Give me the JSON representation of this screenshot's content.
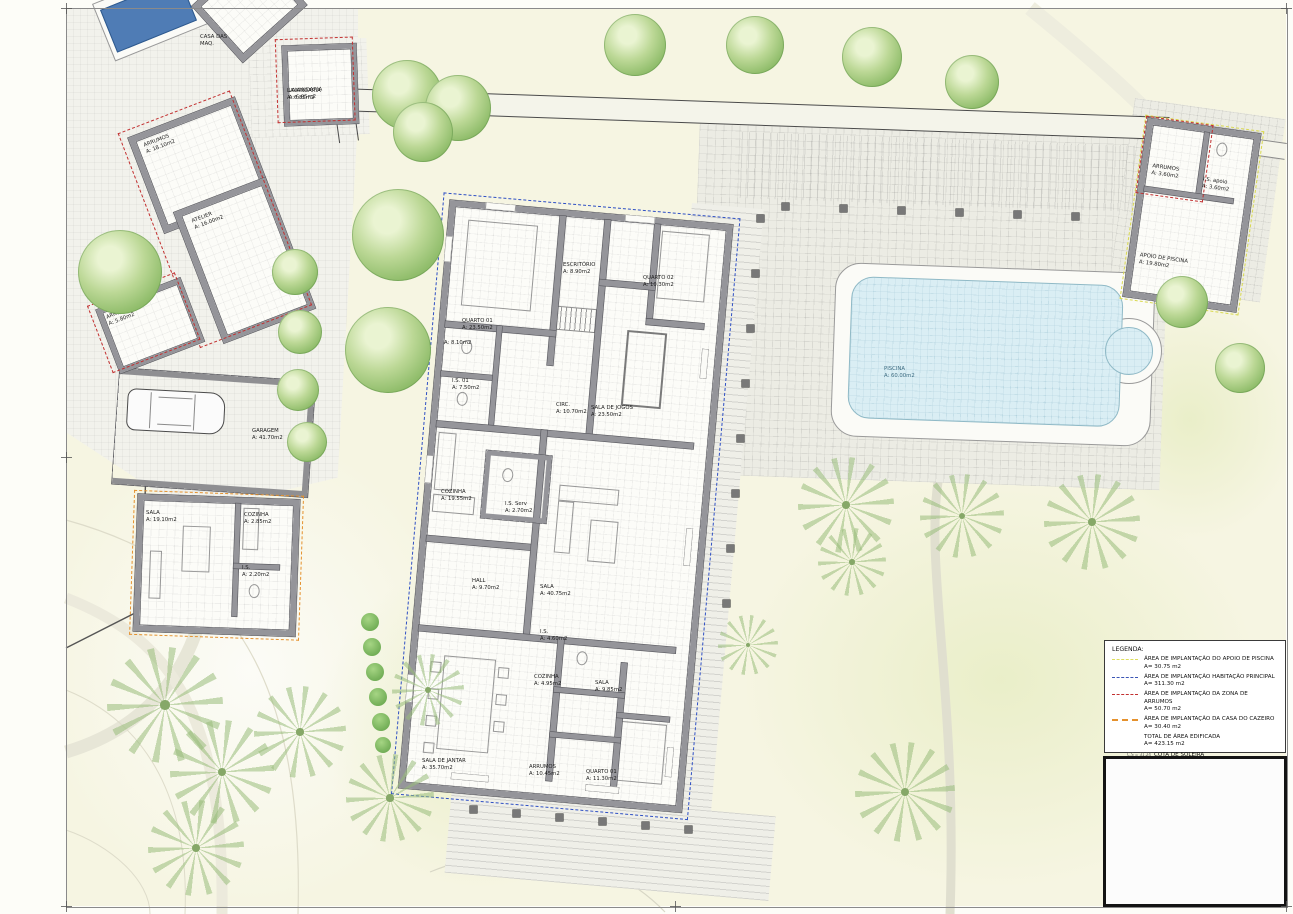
{
  "rooms": {
    "q1": {
      "n": "QUARTO 01",
      "a": "A: 23.50m2"
    },
    "is02": {
      "n": "I.S. 02",
      "a": "A: 8.10m2"
    },
    "escr": {
      "n": "ESCRITÓRIO",
      "a": "A: 8.90m2"
    },
    "q2": {
      "n": "QUARTO 02",
      "a": "A: 10.30m2"
    },
    "is01": {
      "n": "I.S. 01",
      "a": "A: 7.50m2"
    },
    "circ": {
      "n": "CIRC.",
      "a": "A: 10.70m2"
    },
    "jogos": {
      "n": "SALA DE JOGOS",
      "a": "A: 23.50m2"
    },
    "coz": {
      "n": "COZINHA",
      "a": "A: 19.55m2"
    },
    "isserv": {
      "n": "I.S. Serv",
      "a": "A: 2.70m2"
    },
    "hall": {
      "n": "HALL",
      "a": "A: 9.70m2"
    },
    "sala": {
      "n": "SALA",
      "a": "A: 40.75m2"
    },
    "jantar": {
      "n": "SALA DE JANTAR",
      "a": "A: 35.70m2"
    },
    "isb": {
      "n": "I.S.",
      "a": "A: 4.60m2"
    },
    "cozb": {
      "n": "COZINHA",
      "a": "A: 4.95m2"
    },
    "salab": {
      "n": "SALA",
      "a": "A: 9.85m2"
    },
    "arrb": {
      "n": "ARRUMOS",
      "a": "A: 10.45m2"
    },
    "q1b": {
      "n": "QUARTO 01",
      "a": "A: 11.30m2"
    }
  },
  "annex": {
    "casamaq": {
      "n": "CASA DAS",
      "a": "MAQ."
    },
    "lav": {
      "n": "LAVANDARIA",
      "a": "A: 6.85m2"
    },
    "arr18": {
      "n": "ARRUMOS",
      "a": "A: 18.10m2"
    },
    "atelier": {
      "n": "ATELIER",
      "a": "A: 16.00m2"
    },
    "arr5": {
      "n": "ARRUMOS",
      "a": "A: 5.80m2"
    },
    "garagem": {
      "n": "GARAGEM",
      "a": "A: 41.70m2"
    },
    "salac": {
      "n": "SALA",
      "a": "A: 19.10m2"
    },
    "cozc": {
      "n": "COZINHA",
      "a": "A: 2.85m2"
    },
    "isc": {
      "n": "I.S.",
      "a": "A: 2.20m2"
    },
    "arrA": {
      "n": "ARRUMOS",
      "a": "A: 3.60m2"
    },
    "isA": {
      "n": "I.S. apoio",
      "a": "A: 3.60m2"
    },
    "apoio": {
      "n": "APOIO DE PISCINA",
      "a": "A: 19.80m2"
    },
    "piscina": {
      "n": "PISCINA",
      "a": "A: 60.00m2"
    }
  },
  "legend": {
    "title": "LEGENDA:",
    "items": [
      {
        "label": "ÁREA DE IMPLANTAÇÃO DO APOIO DE PISCINA",
        "area": "A= 30.75 m2",
        "color": "#dede5e",
        "style": "dashed"
      },
      {
        "label": "ÁREA DE IMPLANTAÇÃO HABITAÇÃO PRINCIPAL",
        "area": "A= 311.30 m2",
        "color": "#3b55b5",
        "style": "dashed"
      },
      {
        "label": "ÁREA DE IMPLANTAÇÃO DA ZONA DE ARRUMOS",
        "area": "A= 50.70 m2",
        "color": "#c23030",
        "style": "dashed"
      },
      {
        "label": "ÁREA DE IMPLANTAÇÃO DA CASA DO CAZEIRO",
        "area": "A= 30.40 m2",
        "color": "#e5912d",
        "style": "long-dashed"
      },
      {
        "label": "TOTAL DE ÁREA EDIFICADA",
        "area": "A= 423.15 m2"
      },
      {
        "label": "COTA DE SOLEIRA",
        "note": "C.S = 31.24",
        "symbol": "level-mark-icon"
      }
    ]
  }
}
